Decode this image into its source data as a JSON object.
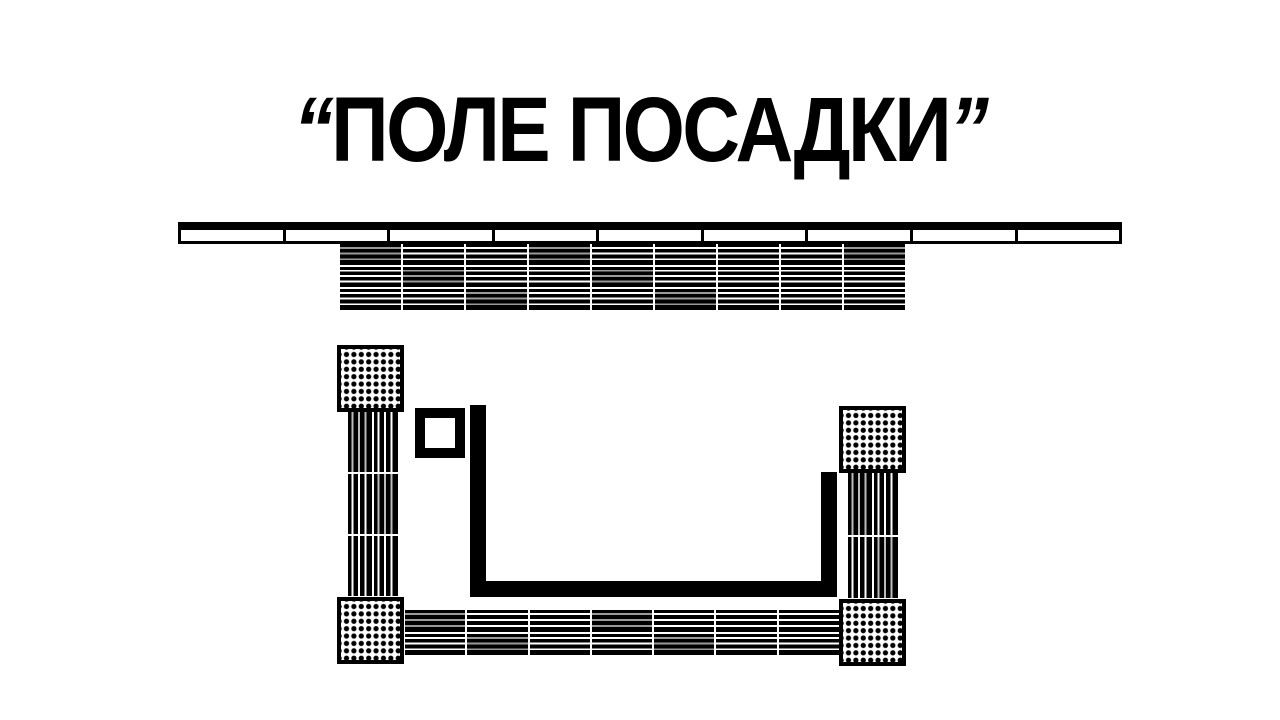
{
  "title": {
    "open_quote": "“",
    "text": "ПОЛЕ ПОСАДКИ",
    "close_quote": "”"
  },
  "colors": {
    "ink": "#000000",
    "paper": "#ffffff",
    "dim_stripe": "#9a9a9a"
  },
  "plan": {
    "shelf_segments": 9,
    "grids": {
      "top_bed": {
        "rows": 3,
        "cols": 9,
        "orientation": "horizontal"
      },
      "bottom_bed": {
        "rows": 2,
        "cols": 7,
        "orientation": "horizontal"
      },
      "left_column": {
        "rows": 3,
        "cols": 2,
        "orientation": "vertical"
      },
      "right_column": {
        "rows": 2,
        "cols": 2,
        "orientation": "vertical"
      }
    },
    "dot_squares": [
      "top-left",
      "bottom-left",
      "top-right",
      "bottom-right"
    ]
  }
}
